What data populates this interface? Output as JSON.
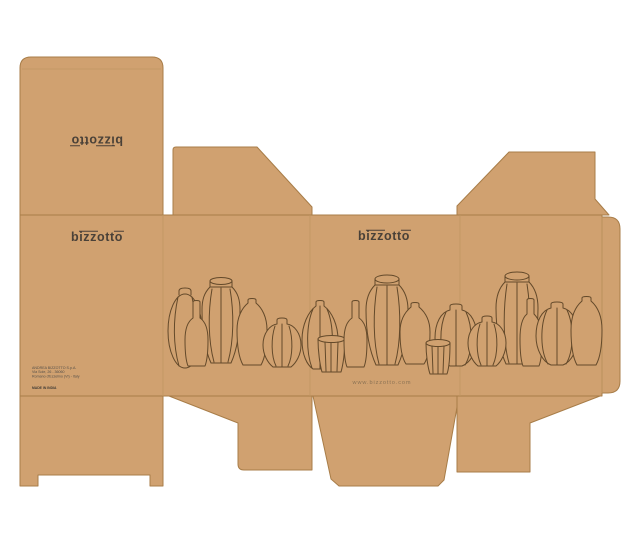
{
  "artboard": {
    "background": "#ffffff",
    "kraft_color": "#d0a170",
    "edge_color": "#a87d48",
    "fold_color": "#bf9763"
  },
  "brand": {
    "name": "bizzotto",
    "logo": {
      "pre": "b",
      "bar1": "izz",
      "mid": "o",
      "tt": "tt",
      "bar2": "o"
    },
    "logo_color": "#4a4138"
  },
  "panels": {
    "top_lid": {
      "note": "bizzotto logo printed rotated 180 degrees"
    },
    "back": {
      "maker_lines": [
        "ANDREA BIZZOTTO S.p.A.",
        "Via Sole, 26 - 36060",
        "Romano d'Ezzelino (VI) - Italy"
      ],
      "made_in": "MADE IN INDIA"
    },
    "front": {
      "website": "www.bizzotto.com"
    }
  },
  "illustration": {
    "description": "Continuous one-line outline drawing of assorted ribbed vases, bottles, urns and cups running across the three wrap panels",
    "stroke_color": "#63492a"
  }
}
